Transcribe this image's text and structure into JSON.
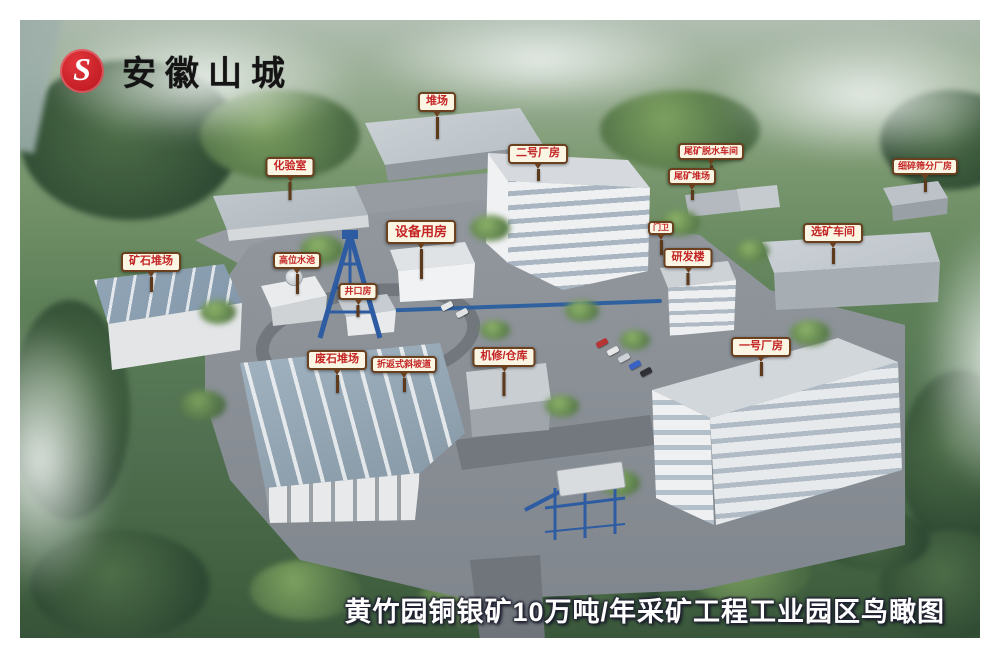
{
  "logo": {
    "company": "安徽山城",
    "mark_letter": "S",
    "color": "#d0202a"
  },
  "caption": {
    "text": "黄竹园铜银矿10万吨/年采矿工程工业园区鸟瞰图"
  },
  "sign_style": {
    "text_color": "#c32424",
    "border_color": "#6a401f",
    "background": "#fbf5e4"
  },
  "labels": [
    {
      "id": "duichang",
      "text": "堆场"
    },
    {
      "id": "huayanshi",
      "text": "化验室"
    },
    {
      "id": "erhao-changfang",
      "text": "二号厂房"
    },
    {
      "id": "weikuang-tuoshui",
      "text": "尾矿脱水车间"
    },
    {
      "id": "weikuang-duichang",
      "text": "尾矿堆场"
    },
    {
      "id": "xisui-shaifen",
      "text": "细碎筛分厂房"
    },
    {
      "id": "xuankuang-chejian",
      "text": "选矿车间"
    },
    {
      "id": "shebei-yongfang",
      "text": "设备用房"
    },
    {
      "id": "gaowei-shuichi",
      "text": "高位水池"
    },
    {
      "id": "jingkou-fang",
      "text": "井口房"
    },
    {
      "id": "menwei",
      "text": "门卫"
    },
    {
      "id": "yanfa-lou",
      "text": "研发楼"
    },
    {
      "id": "kuangshi-duichang",
      "text": "矿石堆场"
    },
    {
      "id": "feishi-duichang",
      "text": "废石堆场"
    },
    {
      "id": "xiepodao",
      "text": "折返式斜坡道"
    },
    {
      "id": "jixiu-cangku",
      "text": "机修/仓库"
    },
    {
      "id": "yihao-changfang",
      "text": "一号厂房"
    }
  ]
}
